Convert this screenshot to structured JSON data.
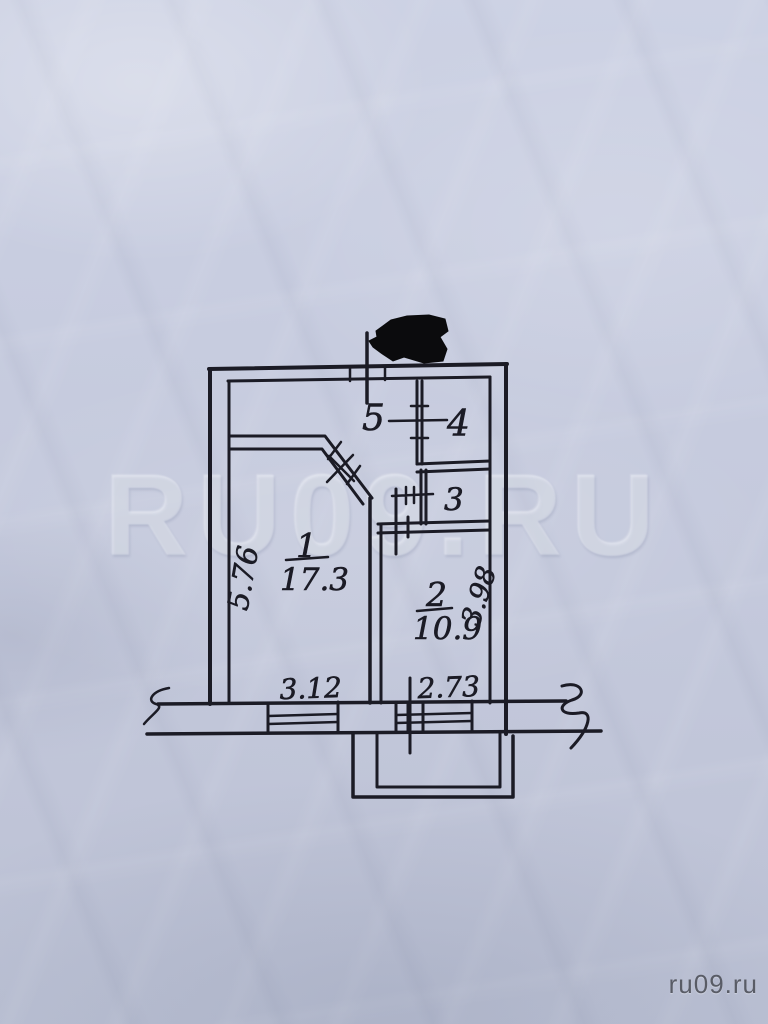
{
  "photo": {
    "watermark_center": "RU09.RU",
    "watermark_corner": "ru09.ru"
  },
  "plan": {
    "type": "apartment-floor-plan",
    "rooms": {
      "room1": {
        "number": "1",
        "area": "17.3"
      },
      "room2": {
        "number": "2",
        "area": "10.9"
      },
      "room3": {
        "number": "3"
      },
      "room4": {
        "number": "4"
      },
      "room5": {
        "number": "5"
      }
    },
    "dimensions": {
      "room1_depth": "5.76",
      "room2_depth": "3.98",
      "window_left_width": "3.12",
      "window_right_width": "2.73"
    },
    "colors": {
      "ink": "#1b1b25",
      "paper": "#c6cbde",
      "redaction": "#0b0b0d"
    }
  }
}
